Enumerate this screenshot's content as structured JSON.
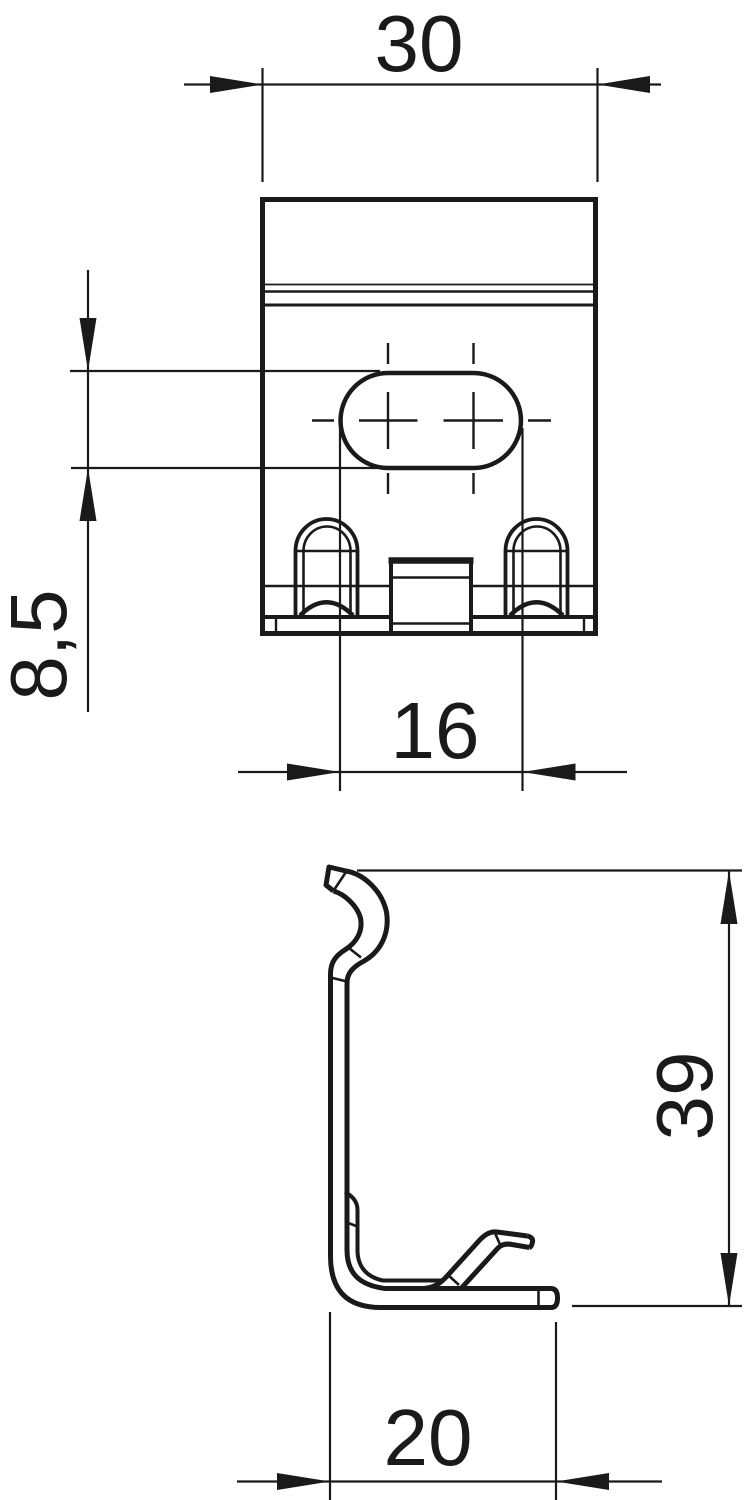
{
  "colors": {
    "background": "#ffffff",
    "line": "#1a1a1a"
  },
  "dimensions": {
    "overall_width": "30",
    "slot_height": "8,5",
    "slot_width": "16",
    "overall_height": "39",
    "foot_depth": "20"
  }
}
